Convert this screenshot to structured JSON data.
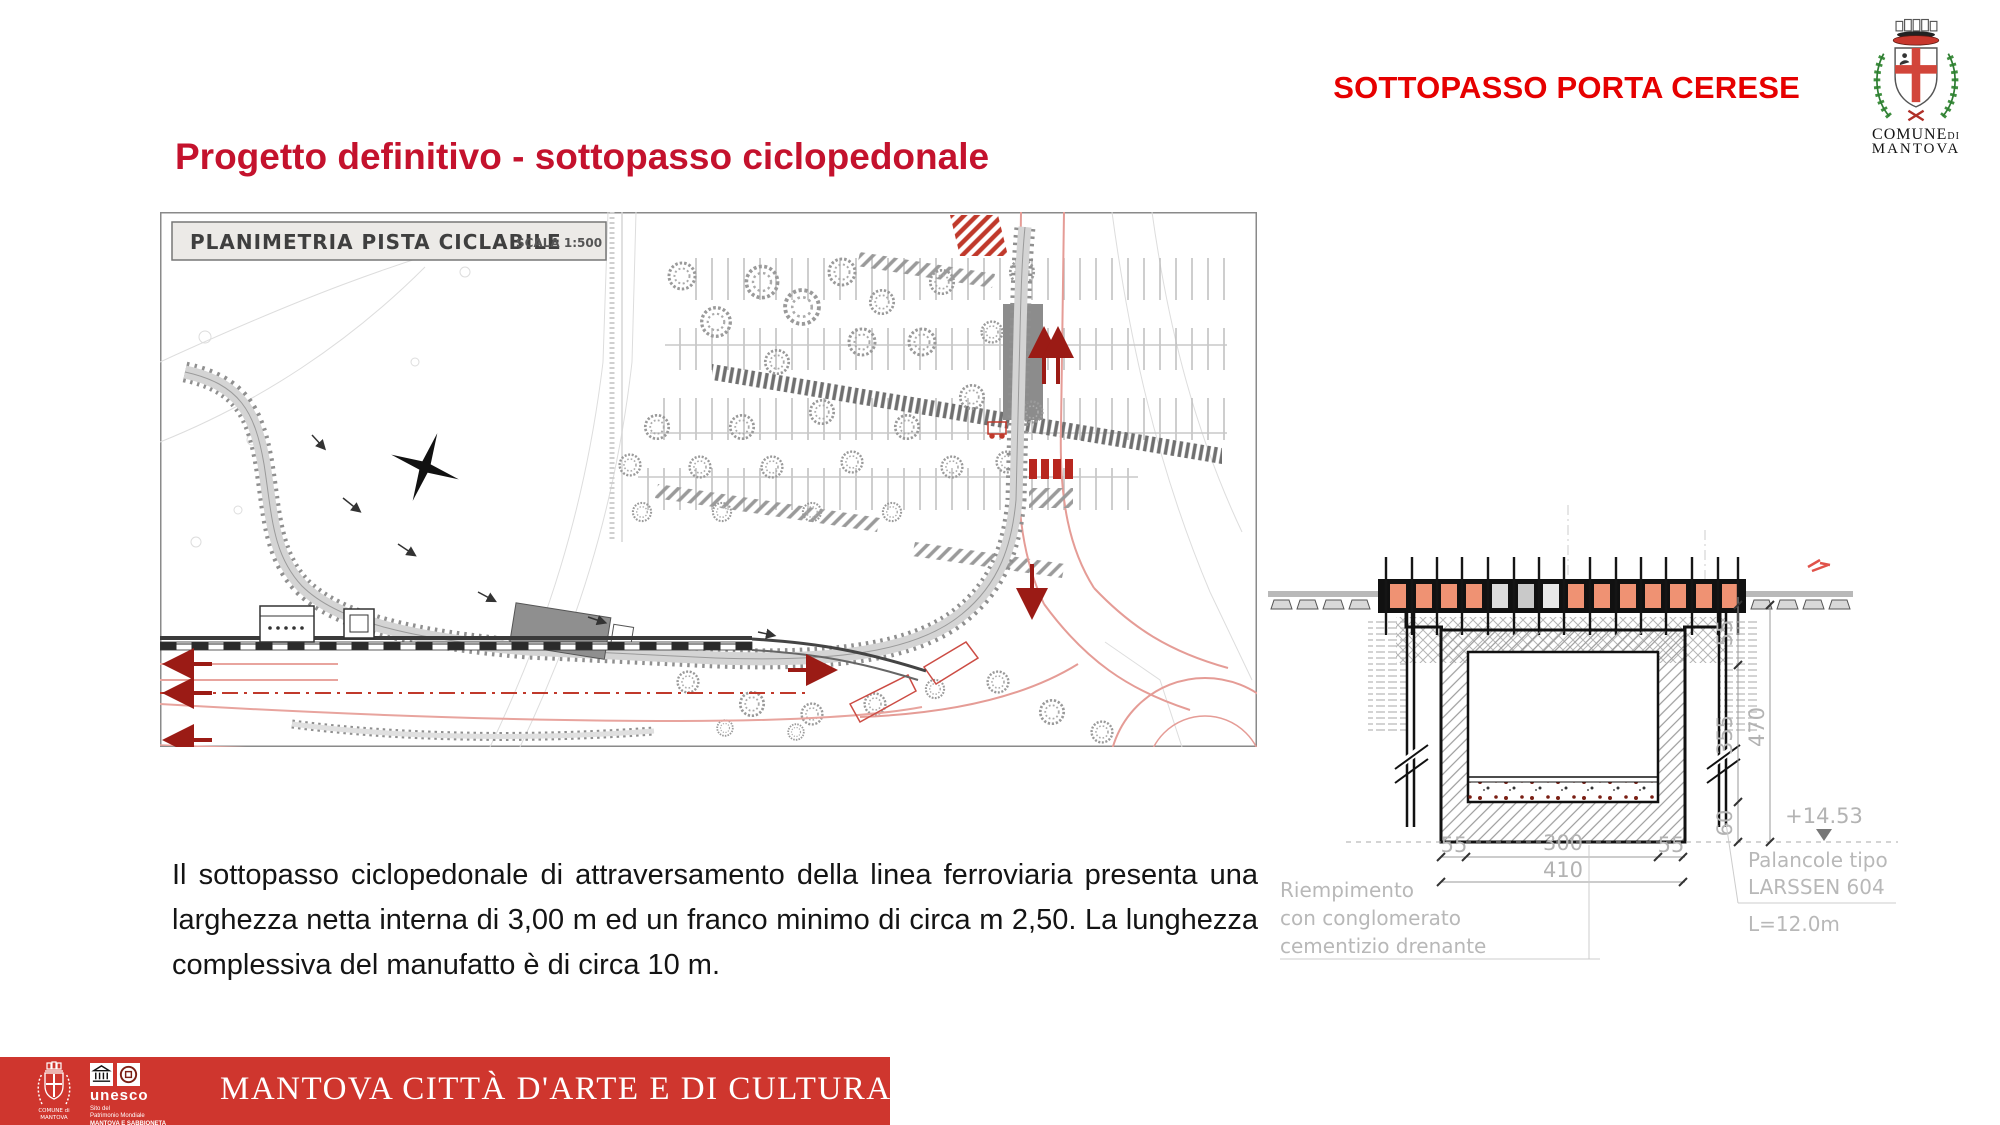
{
  "header": {
    "title": "SOTTOPASSO PORTA CERESE"
  },
  "logo": {
    "comune": "COMUNE",
    "di": "DI",
    "city": "MANTOVA"
  },
  "heading": {
    "text": "Progetto definitivo - sottopasso ciclopedonale"
  },
  "plan": {
    "label": "PLANIMETRIA PISTA CICLABILE",
    "scale": "SCALA 1:500"
  },
  "body": {
    "paragraph": "Il sottopasso ciclopedonale di attraversamento della linea ferroviaria presenta una larghezza netta interna di 3,00 m ed un franco minimo di circa m 2,50. La lunghezza complessiva del manufatto è di circa 10 m."
  },
  "section": {
    "dim_w_left": "55",
    "dim_w_center": "300",
    "dim_w_right": "55",
    "dim_w_total": "410",
    "dim_h_top": "55",
    "dim_h_mid": "355",
    "dim_h_bot": "60",
    "dim_h_total": "470",
    "level": "+14.53",
    "fill_label_1": "Riempimento",
    "fill_label_2": "con  conglomerato",
    "fill_label_3": "cementizio  drenante",
    "pile_label_1": "Palancole  tipo",
    "pile_label_2": "LARSSEN  604",
    "pile_label_3": "L=12.0m"
  },
  "footer": {
    "banner": "MANTOVA CITTÀ D'ARTE E DI CULTURA",
    "unesco_word": "unesco",
    "unesco_sub": [
      "Sito del",
      "Patrimonio Mondiale",
      "MANTOVA E SABBIONETA"
    ],
    "comune_line1": "COMUNE di",
    "comune_line2": "MANTOVA"
  },
  "colors": {
    "accent_red": "#e60000",
    "heading_red": "#c4122d",
    "banner_red": "#cf362e",
    "salmon": "#ef9273"
  }
}
